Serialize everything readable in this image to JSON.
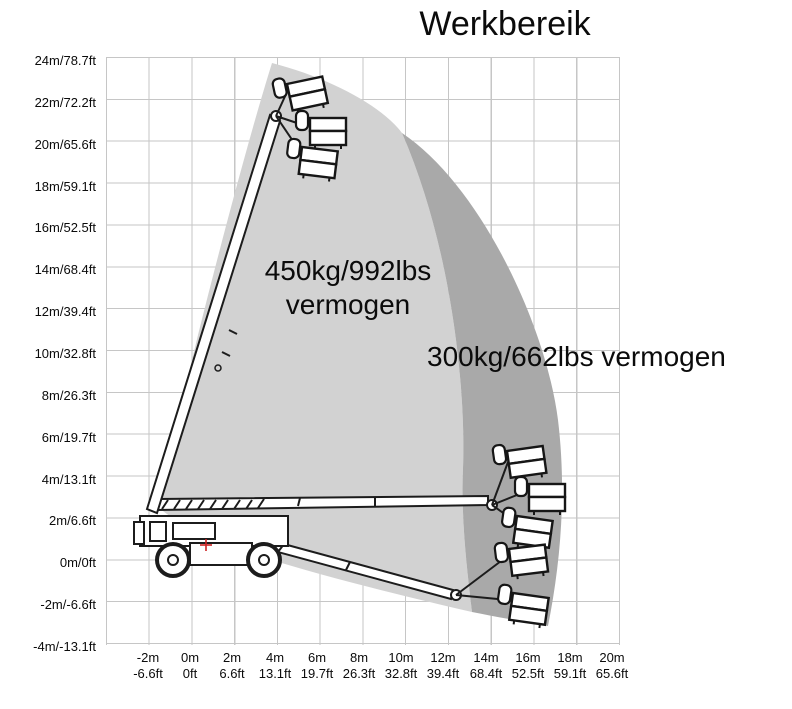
{
  "title": "Werkbereik",
  "chart_data": {
    "type": "area",
    "title": "Werkbereik",
    "grid": true,
    "x_axis": {
      "unit_primary": "m",
      "unit_secondary": "ft",
      "range_m": [
        -4,
        20
      ],
      "tick_step_m": 2,
      "ticks": [
        {
          "m": "-2m",
          "ft": "-6.6ft"
        },
        {
          "m": "0m",
          "ft": "0ft"
        },
        {
          "m": "2m",
          "ft": "6.6ft"
        },
        {
          "m": "4m",
          "ft": "13.1ft"
        },
        {
          "m": "6m",
          "ft": "19.7ft"
        },
        {
          "m": "8m",
          "ft": "26.3ft"
        },
        {
          "m": "10m",
          "ft": "32.8ft"
        },
        {
          "m": "12m",
          "ft": "39.4ft"
        },
        {
          "m": "14m",
          "ft": "68.4ft"
        },
        {
          "m": "16m",
          "ft": "52.5ft"
        },
        {
          "m": "18m",
          "ft": "59.1ft"
        },
        {
          "m": "20m",
          "ft": "65.6ft"
        }
      ]
    },
    "y_axis": {
      "unit_primary": "m",
      "unit_secondary": "ft",
      "range_m": [
        -4,
        24
      ],
      "tick_step_m": 2,
      "ticks": [
        "24m/78.7ft",
        "22m/72.2ft",
        "20m/65.6ft",
        "18m/59.1ft",
        "16m/52.5ft",
        "14m/68.4ft",
        "12m/39.4ft",
        "10m/32.8ft",
        "8m/26.3ft",
        "6m/19.7ft",
        "4m/13.1ft",
        "2m/6.6ft",
        "0m/0ft",
        "-2m/-6.6ft",
        "-4m/-13.1ft"
      ]
    },
    "zones": [
      {
        "name": "inner-envelope",
        "capacity": "450kg/992lbs",
        "label_line1": "450kg/992lbs",
        "label_line2": "vermogen",
        "color": "#d2d2d2",
        "approx_outline_m": [
          [
            3.7,
            23.7
          ],
          [
            1.8,
            12.0
          ],
          [
            2.3,
            2.6
          ],
          [
            7.2,
            0.1
          ],
          [
            13.1,
            -2.6
          ],
          [
            12.7,
            3.0
          ],
          [
            12.8,
            8.4
          ],
          [
            9.8,
            20.4
          ]
        ]
      },
      {
        "name": "outer-envelope",
        "capacity": "300kg/662lbs",
        "label": "300kg/662lbs vermogen",
        "color": "#a9a9a9",
        "approx_outline_m": [
          [
            9.8,
            20.4
          ],
          [
            12.8,
            8.4
          ],
          [
            12.7,
            3.0
          ],
          [
            13.1,
            -2.6
          ],
          [
            16.7,
            -3.2
          ],
          [
            17.4,
            6.3
          ],
          [
            14.4,
            15.0
          ]
        ]
      }
    ],
    "gridline_color": "#c6c6c6"
  },
  "machine": {
    "marker": "rotation-center",
    "marker_color": "#cc2222"
  }
}
